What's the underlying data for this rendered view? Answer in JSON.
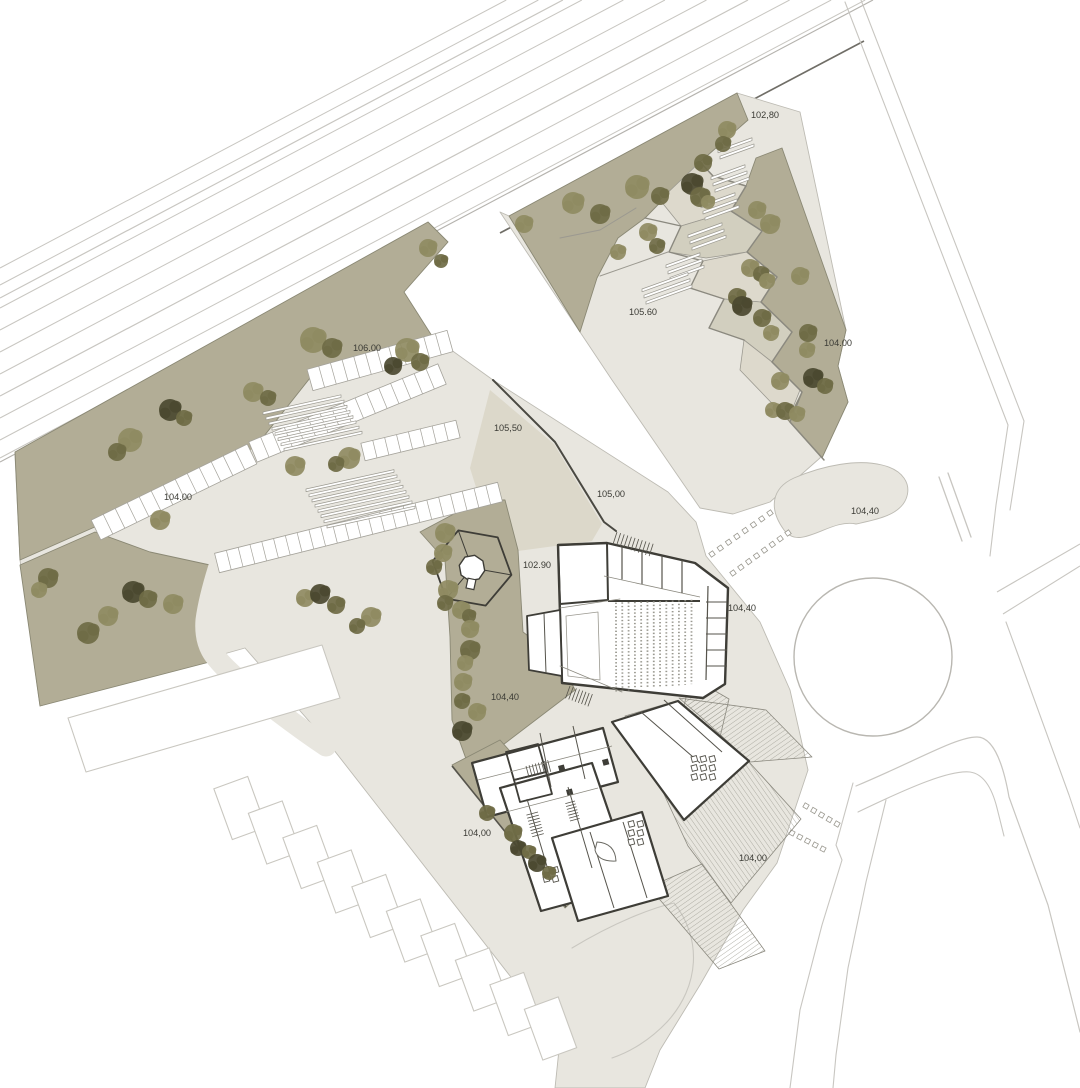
{
  "document": {
    "type": "architectural-site-plan"
  },
  "elevation_labels": [
    {
      "text": "102,80",
      "x": 765,
      "y": 118
    },
    {
      "text": "105.60",
      "x": 643,
      "y": 315
    },
    {
      "text": "104.00",
      "x": 838,
      "y": 346
    },
    {
      "text": "106.00",
      "x": 367,
      "y": 351
    },
    {
      "text": "104.00",
      "x": 178,
      "y": 500
    },
    {
      "text": "105,50",
      "x": 508,
      "y": 431
    },
    {
      "text": "105,00",
      "x": 611,
      "y": 497
    },
    {
      "text": "104,40",
      "x": 865,
      "y": 514
    },
    {
      "text": "102.90",
      "x": 537,
      "y": 568
    },
    {
      "text": "104,40",
      "x": 742,
      "y": 611
    },
    {
      "text": "104,40",
      "x": 505,
      "y": 700
    },
    {
      "text": "104,00",
      "x": 477,
      "y": 836
    },
    {
      "text": "104,00",
      "x": 753,
      "y": 861
    }
  ],
  "colors": {
    "pavement": "#e8e6df",
    "pavement_dark": "#dcd8ca",
    "green": "#b2ad96",
    "terrace_a": "#ddd9cc",
    "terrace_b": "#d2cfbf",
    "wall_dark": "#3e3d37",
    "wall_mid": "#55534b",
    "edge": "#bdbbb3",
    "green_edge": "#8a8874",
    "road_line": "#c8c6c1",
    "rail_dark": "#706e67",
    "hatch": "#9b9990",
    "tree_light": "#8f8b62",
    "tree_mid": "#6f6b45",
    "tree_dark": "#4b4930",
    "label": "#3b3b35"
  },
  "trees": [
    [
      313,
      340,
      13,
      0
    ],
    [
      332,
      348,
      10,
      1
    ],
    [
      407,
      350,
      12,
      0
    ],
    [
      393,
      366,
      9,
      2
    ],
    [
      420,
      362,
      9,
      1
    ],
    [
      428,
      248,
      9,
      0
    ],
    [
      441,
      261,
      7,
      1
    ],
    [
      170,
      410,
      11,
      2
    ],
    [
      184,
      418,
      8,
      1
    ],
    [
      130,
      440,
      12,
      0
    ],
    [
      117,
      452,
      9,
      1
    ],
    [
      253,
      392,
      10,
      0
    ],
    [
      268,
      398,
      8,
      1
    ],
    [
      160,
      520,
      10,
      0
    ],
    [
      295,
      466,
      10,
      0
    ],
    [
      349,
      458,
      11,
      0
    ],
    [
      336,
      464,
      8,
      1
    ],
    [
      48,
      578,
      10,
      1
    ],
    [
      39,
      590,
      8,
      0
    ],
    [
      88,
      633,
      11,
      1
    ],
    [
      108,
      616,
      10,
      0
    ],
    [
      133,
      592,
      11,
      2
    ],
    [
      148,
      599,
      9,
      1
    ],
    [
      173,
      604,
      10,
      0
    ],
    [
      305,
      598,
      9,
      0
    ],
    [
      320,
      594,
      10,
      2
    ],
    [
      336,
      605,
      9,
      1
    ],
    [
      371,
      617,
      10,
      0
    ],
    [
      357,
      626,
      8,
      1
    ],
    [
      445,
      533,
      10,
      0
    ],
    [
      443,
      553,
      9,
      0
    ],
    [
      434,
      567,
      8,
      1
    ],
    [
      448,
      590,
      10,
      0
    ],
    [
      445,
      603,
      8,
      1
    ],
    [
      461,
      610,
      9,
      0
    ],
    [
      469,
      616,
      7,
      1
    ],
    [
      470,
      629,
      9,
      0
    ],
    [
      470,
      650,
      10,
      1
    ],
    [
      465,
      663,
      8,
      0
    ],
    [
      463,
      682,
      9,
      0
    ],
    [
      462,
      701,
      8,
      1
    ],
    [
      477,
      712,
      9,
      0
    ],
    [
      462,
      731,
      10,
      2
    ],
    [
      487,
      813,
      8,
      1
    ],
    [
      513,
      833,
      9,
      1
    ],
    [
      518,
      848,
      8,
      2
    ],
    [
      529,
      852,
      7,
      1
    ],
    [
      537,
      863,
      9,
      2
    ],
    [
      549,
      873,
      7,
      1
    ],
    [
      524,
      224,
      9,
      0
    ],
    [
      573,
      203,
      11,
      0
    ],
    [
      600,
      214,
      10,
      1
    ],
    [
      637,
      187,
      12,
      0
    ],
    [
      660,
      196,
      9,
      1
    ],
    [
      692,
      184,
      11,
      2
    ],
    [
      648,
      232,
      9,
      0
    ],
    [
      657,
      246,
      8,
      1
    ],
    [
      618,
      252,
      8,
      0
    ],
    [
      727,
      130,
      9,
      0
    ],
    [
      723,
      144,
      8,
      1
    ],
    [
      703,
      163,
      9,
      1
    ],
    [
      700,
      197,
      10,
      1
    ],
    [
      708,
      202,
      7,
      0
    ],
    [
      757,
      210,
      9,
      0
    ],
    [
      770,
      224,
      10,
      0
    ],
    [
      750,
      268,
      9,
      0
    ],
    [
      761,
      274,
      8,
      1
    ],
    [
      737,
      297,
      9,
      1
    ],
    [
      767,
      281,
      8,
      0
    ],
    [
      800,
      276,
      9,
      0
    ],
    [
      742,
      306,
      10,
      2
    ],
    [
      762,
      318,
      9,
      1
    ],
    [
      771,
      333,
      8,
      0
    ],
    [
      808,
      333,
      9,
      1
    ],
    [
      807,
      350,
      8,
      0
    ],
    [
      813,
      378,
      10,
      2
    ],
    [
      825,
      386,
      8,
      1
    ],
    [
      780,
      381,
      9,
      0
    ],
    [
      773,
      410,
      8,
      0
    ],
    [
      785,
      411,
      9,
      1
    ],
    [
      797,
      414,
      8,
      0
    ]
  ]
}
